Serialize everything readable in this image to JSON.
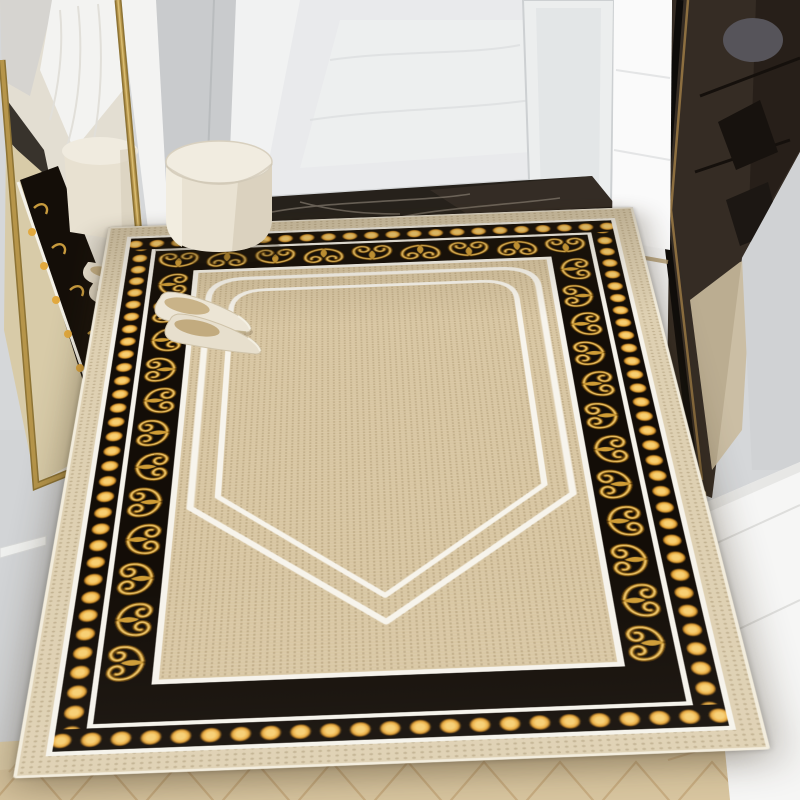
{
  "scene": {
    "type": "entryway interior product photo",
    "subject": "baroque black and gold bordered doormat",
    "elements": [
      "gold-framed leaning mirror with reflection",
      "cream round ottoman",
      "pair of cream pointed flat shoes",
      "bright hallway with white doors",
      "dark marble threshold strip",
      "white frosted glass door",
      "smoked glass wardrobe with shelves",
      "white shoe cabinet",
      "light oak herringbone floor"
    ]
  },
  "palette": {
    "wall_gray": "#d4d6d8",
    "wall_panel": "#c9cbcd",
    "hall_floor": "#e9eaec",
    "door_white": "#f3f4f4",
    "marble_dark": "#26211b",
    "mirror_gold": "#b6954a",
    "glass_dark": "#352c24",
    "glass_bronze": "#8d6f40",
    "cabinet_white": "#f6f6f5",
    "wood_light": "#d9c6a0",
    "wood_seam": "#c2a477",
    "ottoman_cream": "#eee8d9",
    "shoe_cream": "#ece5d5",
    "shoe_insole": "#c9b388",
    "rug_black": "#130d07",
    "rug_gold": "#cf9c35",
    "rug_gold_light": "#efca76",
    "rug_gold_dark": "#5e3d0a",
    "rug_dot": "#e8a93c",
    "rug_field": "#d8c6a2",
    "rug_outer_band": "#ded0b2",
    "rug_white_line": "#f6f3eb"
  },
  "rug": {
    "motifs": {
      "horizontal_count": 9,
      "vertical_count": 12
    },
    "dot_spacing_px": 25,
    "bands": [
      "beige outer band",
      "white line",
      "gold dot row on black",
      "white line",
      "gold acanthus scroll band on black",
      "white line",
      "beige field with double white shield lines"
    ]
  }
}
